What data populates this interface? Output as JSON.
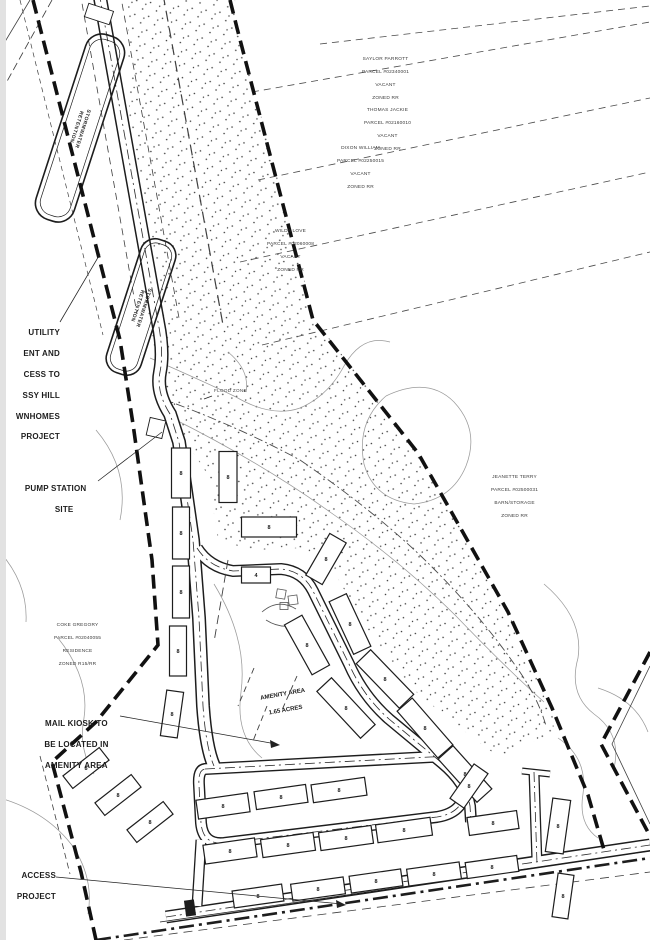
{
  "page": {
    "background": "#ffffff",
    "ink": "#1d1d1d",
    "contour_color": "#9a9a9a"
  },
  "ponds": [
    {
      "label_lines": [
        "STORMWATER",
        "RETENTION"
      ]
    },
    {
      "label_lines": [
        "STORMWATER",
        "RETENTION"
      ]
    }
  ],
  "parcels": [
    {
      "lines": [
        "SAYLOR PARROTT",
        "PARCEL #02340001",
        "VACANT",
        "ZONED RR"
      ]
    },
    {
      "lines": [
        "THOMAS JACKIE",
        "PARCEL #02160010",
        "VACANT",
        "ZONED RR"
      ]
    },
    {
      "lines": [
        "DIXON WILLIAM",
        "PARCEL #02250015",
        "VACANT",
        "ZONED RR"
      ]
    },
    {
      "lines": [
        "WILDA LOVE",
        "PARCEL #02060008",
        "VACANT",
        "ZONED RR"
      ]
    },
    {
      "lines": [
        "JEANETTE TERRY",
        "PARCEL #02500031",
        "BARN/STORAGE",
        "ZONED RR"
      ]
    },
    {
      "lines": [
        "COKE GREGORY",
        "PARCEL #02040055",
        "RESIDENCE",
        "ZONED R15/RR"
      ]
    }
  ],
  "annotations": {
    "utility_note": {
      "lines": [
        "UTILITY",
        "ENT AND",
        "CESS TO",
        "SSY HILL",
        "WNHOMES",
        "PROJECT"
      ]
    },
    "pump_station": {
      "lines": [
        "PUMP STATION",
        "SITE"
      ]
    },
    "flood_zone": {
      "text": "FLOOD ZONE"
    },
    "amenity_area": {
      "lines": [
        "AMENITY AREA",
        "1.65 ACRES"
      ]
    },
    "mail_kiosk": {
      "lines": [
        "MAIL KIOSK TO",
        "BE LOCATED IN",
        "AMENITY AREA"
      ]
    },
    "access_note": {
      "lines": [
        "ACCESS",
        "PROJECT"
      ]
    }
  },
  "buildings": [
    {
      "cx": 181,
      "cy": 473,
      "w": 19,
      "h": 50,
      "angle": 0,
      "units": "8"
    },
    {
      "cx": 181,
      "cy": 533,
      "w": 17,
      "h": 52,
      "angle": 0,
      "units": "8"
    },
    {
      "cx": 181,
      "cy": 592,
      "w": 17,
      "h": 52,
      "angle": 0,
      "units": "8"
    },
    {
      "cx": 178,
      "cy": 651,
      "w": 17,
      "h": 50,
      "angle": 0,
      "units": "8"
    },
    {
      "cx": 172,
      "cy": 714,
      "w": 17,
      "h": 46,
      "angle": 8,
      "units": "8"
    },
    {
      "cx": 228,
      "cy": 477,
      "w": 18,
      "h": 51,
      "angle": 0,
      "units": "8"
    },
    {
      "cx": 269,
      "cy": 527,
      "w": 55,
      "h": 20,
      "angle": 0,
      "units": "8"
    },
    {
      "cx": 256,
      "cy": 575,
      "w": 29,
      "h": 16,
      "angle": 0,
      "units": "4"
    },
    {
      "cx": 326,
      "cy": 559,
      "w": 48,
      "h": 19,
      "angle": -60,
      "units": "8"
    },
    {
      "cx": 307,
      "cy": 645,
      "w": 57,
      "h": 20,
      "angle": 61,
      "units": "8"
    },
    {
      "cx": 350,
      "cy": 624,
      "w": 58,
      "h": 19,
      "angle": 65,
      "units": "8"
    },
    {
      "cx": 385,
      "cy": 679,
      "w": 62,
      "h": 20,
      "angle": 46,
      "units": "8"
    },
    {
      "cx": 346,
      "cy": 708,
      "w": 64,
      "h": 20,
      "angle": 47,
      "units": "8"
    },
    {
      "cx": 425,
      "cy": 728,
      "w": 62,
      "h": 20,
      "angle": 49,
      "units": "8"
    },
    {
      "cx": 465,
      "cy": 774,
      "w": 58,
      "h": 20,
      "angle": 48,
      "units": "8"
    },
    {
      "cx": 86,
      "cy": 768,
      "w": 46,
      "h": 16,
      "angle": -38,
      "units": "8"
    },
    {
      "cx": 118,
      "cy": 795,
      "w": 46,
      "h": 16,
      "angle": -38,
      "units": "8"
    },
    {
      "cx": 150,
      "cy": 822,
      "w": 46,
      "h": 16,
      "angle": -38,
      "units": "8"
    },
    {
      "cx": 223,
      "cy": 806,
      "w": 52,
      "h": 19,
      "angle": -8,
      "units": "8"
    },
    {
      "cx": 281,
      "cy": 797,
      "w": 52,
      "h": 18,
      "angle": -8,
      "units": "8"
    },
    {
      "cx": 339,
      "cy": 790,
      "w": 54,
      "h": 18,
      "angle": -8,
      "units": "8"
    },
    {
      "cx": 230,
      "cy": 851,
      "w": 52,
      "h": 19,
      "angle": -8,
      "units": "8"
    },
    {
      "cx": 288,
      "cy": 845,
      "w": 53,
      "h": 18,
      "angle": -8,
      "units": "8"
    },
    {
      "cx": 346,
      "cy": 838,
      "w": 53,
      "h": 18,
      "angle": -8,
      "units": "8"
    },
    {
      "cx": 404,
      "cy": 830,
      "w": 55,
      "h": 18,
      "angle": -8,
      "units": "8"
    },
    {
      "cx": 469,
      "cy": 786,
      "w": 42,
      "h": 17,
      "angle": -55,
      "units": "8"
    },
    {
      "cx": 493,
      "cy": 823,
      "w": 50,
      "h": 18,
      "angle": -8,
      "units": "8"
    },
    {
      "cx": 558,
      "cy": 826,
      "w": 18,
      "h": 54,
      "angle": 8,
      "units": "8"
    },
    {
      "cx": 563,
      "cy": 896,
      "w": 16,
      "h": 44,
      "angle": 8,
      "units": "8"
    },
    {
      "cx": 258,
      "cy": 896,
      "w": 50,
      "h": 17,
      "angle": -8,
      "units": "8"
    },
    {
      "cx": 318,
      "cy": 889,
      "w": 53,
      "h": 17,
      "angle": -8,
      "units": "8"
    },
    {
      "cx": 376,
      "cy": 881,
      "w": 52,
      "h": 17,
      "angle": -8,
      "units": "8"
    },
    {
      "cx": 434,
      "cy": 874,
      "w": 53,
      "h": 17,
      "angle": -8,
      "units": "8"
    },
    {
      "cx": 492,
      "cy": 867,
      "w": 52,
      "h": 16,
      "angle": -8,
      "units": "8"
    }
  ]
}
